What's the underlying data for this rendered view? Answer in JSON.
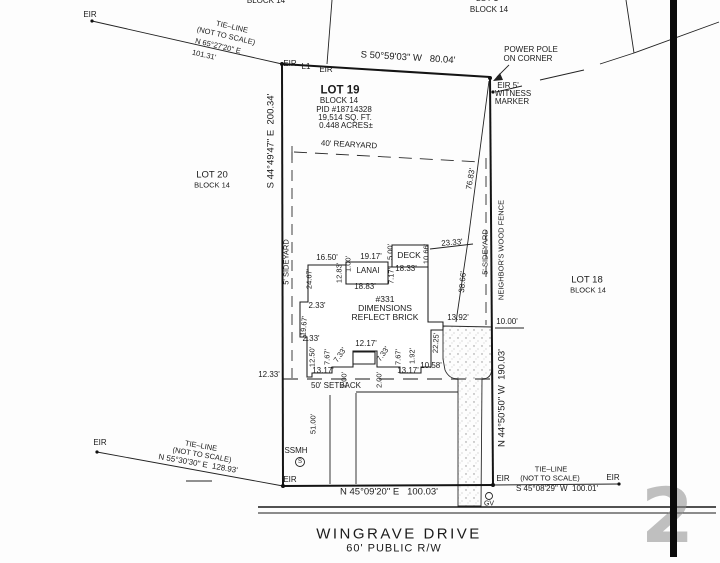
{
  "parcel": {
    "lot": "LOT 19",
    "block": "BLOCK 14",
    "pid": "PID #18714328",
    "area_sqft": "19,514 SQ. FT.",
    "area_acres": "0.448 ACRES±",
    "house_number": "#331",
    "note": "DIMENSIONS REFLECT BRICK"
  },
  "street": {
    "name": "WINGRAVE DRIVE",
    "right_of_way": "60' PUBLIC R/W"
  },
  "boundaries": {
    "north": "S 50°59'03\" W 80.04'",
    "west": "S 44°49'47\" E 200.34'",
    "east": "N 44°50'50\" W 190.03'",
    "south": "N 45°09'20\" E 100.03'"
  },
  "adjacent_lots": [
    "LOT 20 BLOCK 14",
    "LOT 18 BLOCK 14",
    "BLOCK 14 (north)",
    "LOT 1 BLOCK 14 (northeast)"
  ],
  "watermark": "2",
  "colors": {
    "line": "#1b1b1b",
    "setback_dash": "#8a8a8a",
    "stipple": "#8f8f8f",
    "bar": "#0b0b0b"
  },
  "labels": [
    {
      "id": "block-label-top-left",
      "t": "BLOCK 14",
      "x": 266,
      "y": 1,
      "s": 8
    },
    {
      "id": "lot-label-top-right",
      "t": "LOT 1",
      "x": 487,
      "y": -1,
      "s": 8
    },
    {
      "id": "block-label-top-right",
      "t": "BLOCK 14",
      "x": 489,
      "y": 10,
      "s": 8
    },
    {
      "id": "eir-marker-label",
      "t": "EIR",
      "x": 90,
      "y": 15,
      "s": 8
    },
    {
      "id": "tie-line-nw-title",
      "t": "TIE–LINE",
      "x": 232,
      "y": 27,
      "s": 7.5,
      "rot": 13
    },
    {
      "id": "tie-line-nw-note",
      "t": "(NOT TO SCALE)",
      "x": 226,
      "y": 36,
      "s": 7.5,
      "rot": 13
    },
    {
      "id": "tie-line-nw-bearing",
      "t": "N 65°27'20\" E",
      "x": 218,
      "y": 46,
      "s": 7.5,
      "rot": 13
    },
    {
      "id": "tie-line-nw-distance",
      "t": "101.31'",
      "x": 204,
      "y": 55,
      "s": 7.5,
      "rot": 13
    },
    {
      "id": "bearing-north",
      "t": "S 50°59'03\" W   80.04'",
      "x": 408,
      "y": 58,
      "s": 9.5,
      "rot": 3.5
    },
    {
      "id": "eir-marker-label",
      "t": "EIR",
      "x": 290,
      "y": 64,
      "s": 8
    },
    {
      "id": "line-l1-label",
      "t": "L1",
      "x": 306,
      "y": 67,
      "s": 8
    },
    {
      "id": "eir-marker-label",
      "t": "EIR",
      "x": 326,
      "y": 70,
      "s": 8
    },
    {
      "id": "power-pole-note-1",
      "t": "POWER POLE",
      "x": 531,
      "y": 50,
      "s": 8
    },
    {
      "id": "power-pole-note-2",
      "t": "ON CORNER",
      "x": 528,
      "y": 59,
      "s": 8
    },
    {
      "id": "witness-marker-note-1",
      "t": "EIR 5'",
      "x": 508,
      "y": 86,
      "s": 8
    },
    {
      "id": "witness-marker-note-2",
      "t": "WITNESS",
      "x": 513,
      "y": 94,
      "s": 8
    },
    {
      "id": "witness-marker-note-3",
      "t": "MARKER",
      "x": 512,
      "y": 102,
      "s": 8
    },
    {
      "id": "lot19-name",
      "t": "LOT 19",
      "x": 340,
      "y": 91,
      "s": 11.5,
      "w": 700
    },
    {
      "id": "lot19-block",
      "t": "BLOCK 14",
      "x": 339,
      "y": 101,
      "s": 8
    },
    {
      "id": "lot19-pid",
      "t": "PID #18714328",
      "x": 344,
      "y": 110,
      "s": 8
    },
    {
      "id": "lot19-area-sqft",
      "t": "19,514 SQ. FT.",
      "x": 345,
      "y": 118,
      "s": 8
    },
    {
      "id": "lot19-area-acres",
      "t": "0.448 ACRES±",
      "x": 346,
      "y": 126,
      "s": 8
    },
    {
      "id": "rearyard-label",
      "t": "40' REARYARD",
      "x": 349,
      "y": 145,
      "s": 8,
      "rot": 3
    },
    {
      "id": "lot20-name",
      "t": "LOT 20",
      "x": 212,
      "y": 175,
      "s": 9.5
    },
    {
      "id": "lot20-block",
      "t": "BLOCK 14",
      "x": 212,
      "y": 185,
      "s": 7.5
    },
    {
      "id": "lot18-name",
      "t": "LOT 18",
      "x": 587,
      "y": 280,
      "s": 9.5
    },
    {
      "id": "lot18-block",
      "t": "BLOCK 14",
      "x": 588,
      "y": 290,
      "s": 7.5
    },
    {
      "id": "bearing-west",
      "t": "S 44°49'47\" E  200.34'",
      "x": 271,
      "y": 141,
      "s": 9.5,
      "rot": -90
    },
    {
      "id": "sideyard-west-label",
      "t": "5' SIDEYARD",
      "x": 286,
      "y": 262,
      "s": 7.5,
      "rot": -90
    },
    {
      "id": "dim",
      "t": "76.83'",
      "x": 471,
      "y": 179,
      "s": 8,
      "rot": -80
    },
    {
      "id": "fence-label",
      "t": "NEIGHBOR'S WOOD FENCE",
      "x": 501,
      "y": 250,
      "s": 7.5,
      "rot": -90
    },
    {
      "id": "sideyard-east-label",
      "t": "5' SIDEYARD",
      "x": 485,
      "y": 252,
      "s": 7.5,
      "rot": -90
    },
    {
      "id": "dim",
      "t": "38.66'",
      "x": 463,
      "y": 282,
      "s": 8,
      "rot": -85
    },
    {
      "id": "dim",
      "t": "23.33'",
      "x": 452,
      "y": 243,
      "s": 8,
      "rot": -5
    },
    {
      "id": "dim",
      "t": "16.50'",
      "x": 327,
      "y": 258,
      "s": 8
    },
    {
      "id": "dim",
      "t": "1.00'",
      "x": 348,
      "y": 264,
      "s": 7.5,
      "rot": -90
    },
    {
      "id": "dim",
      "t": "12.83'",
      "x": 339,
      "y": 273,
      "s": 7.5,
      "rot": -90
    },
    {
      "id": "dim",
      "t": "19.17'",
      "x": 371,
      "y": 257,
      "s": 8
    },
    {
      "id": "lanai-label",
      "t": "LANAI",
      "x": 368,
      "y": 271,
      "s": 8
    },
    {
      "id": "dim",
      "t": "5.00'",
      "x": 390,
      "y": 252,
      "s": 7.5,
      "rot": -90
    },
    {
      "id": "deck-label",
      "t": "DECK",
      "x": 409,
      "y": 255,
      "s": 8.5
    },
    {
      "id": "dim",
      "t": "10.66'",
      "x": 426,
      "y": 254,
      "s": 7.5,
      "rot": -90
    },
    {
      "id": "dim",
      "t": "18.33'",
      "x": 406,
      "y": 269,
      "s": 8
    },
    {
      "id": "dim",
      "t": "7.17'",
      "x": 391,
      "y": 276,
      "s": 7.5,
      "rot": -90
    },
    {
      "id": "dim",
      "t": "18.83'",
      "x": 365,
      "y": 287,
      "s": 8
    },
    {
      "id": "dim",
      "t": "24.67'",
      "x": 309,
      "y": 279,
      "s": 7.5,
      "rot": -90
    },
    {
      "id": "dim",
      "t": "2.33'",
      "x": 317,
      "y": 306,
      "s": 8
    },
    {
      "id": "dim",
      "t": "19.67'",
      "x": 304,
      "y": 326,
      "s": 7.5,
      "rot": -85
    },
    {
      "id": "house-number",
      "t": "#331",
      "x": 385,
      "y": 299,
      "s": 8.5
    },
    {
      "id": "house-note-1",
      "t": "DIMENSIONS",
      "x": 385,
      "y": 308,
      "s": 8.5
    },
    {
      "id": "house-note-2",
      "t": "REFLECT BRICK",
      "x": 385,
      "y": 317,
      "s": 8.5
    },
    {
      "id": "dim",
      "t": "13.92'",
      "x": 458,
      "y": 318,
      "s": 8
    },
    {
      "id": "dim",
      "t": "10.00'",
      "x": 507,
      "y": 322,
      "s": 8
    },
    {
      "id": "dim",
      "t": "2.33'",
      "x": 311,
      "y": 339,
      "s": 8
    },
    {
      "id": "dim",
      "t": "12.50'",
      "x": 312,
      "y": 357,
      "s": 7.5,
      "rot": -90
    },
    {
      "id": "dim",
      "t": "7.67'",
      "x": 327,
      "y": 357,
      "s": 7.5,
      "rot": -90
    },
    {
      "id": "dim",
      "t": "7.33'",
      "x": 340,
      "y": 355,
      "s": 7.5,
      "rot": -55
    },
    {
      "id": "dim",
      "t": "12.17'",
      "x": 366,
      "y": 344,
      "s": 8
    },
    {
      "id": "dim",
      "t": "7.33'",
      "x": 383,
      "y": 354,
      "s": 7.5,
      "rot": -55
    },
    {
      "id": "dim",
      "t": "7.67'",
      "x": 398,
      "y": 357,
      "s": 7.5,
      "rot": -90
    },
    {
      "id": "dim",
      "t": "1.92'",
      "x": 412,
      "y": 356,
      "s": 7.5,
      "rot": -90
    },
    {
      "id": "dim",
      "t": "10.58'",
      "x": 431,
      "y": 366,
      "s": 8
    },
    {
      "id": "dim",
      "t": "22.25'",
      "x": 436,
      "y": 343,
      "s": 7.5,
      "rot": -87
    },
    {
      "id": "dim",
      "t": "13.17'",
      "x": 323,
      "y": 371,
      "s": 8
    },
    {
      "id": "dim",
      "t": "2.00'",
      "x": 344,
      "y": 380,
      "s": 7.5,
      "rot": -90
    },
    {
      "id": "dim",
      "t": "2.00'",
      "x": 379,
      "y": 380,
      "s": 7.5,
      "rot": -90
    },
    {
      "id": "dim",
      "t": "13.17'",
      "x": 408,
      "y": 371,
      "s": 8
    },
    {
      "id": "dim",
      "t": "12.33'",
      "x": 269,
      "y": 375,
      "s": 8
    },
    {
      "id": "setback-label",
      "t": "50' SETBACK",
      "x": 336,
      "y": 386,
      "s": 8
    },
    {
      "id": "dim",
      "t": "51.00'",
      "x": 313,
      "y": 424,
      "s": 7.5,
      "rot": -90
    },
    {
      "id": "bearing-east",
      "t": "N 44°50'50\" W  190.03'",
      "x": 502,
      "y": 398,
      "s": 9.5,
      "rot": -90
    },
    {
      "id": "ssmh-label",
      "t": "SSMH",
      "x": 296,
      "y": 451,
      "s": 8
    },
    {
      "id": "ssmh-symbol-letter",
      "t": "S",
      "x": 300,
      "y": 462,
      "s": 6
    },
    {
      "id": "eir-marker-label",
      "t": "EIR",
      "x": 100,
      "y": 443,
      "s": 8
    },
    {
      "id": "tie-line-sw-title",
      "t": "TIE–LINE",
      "x": 201,
      "y": 446,
      "s": 7.5,
      "rot": 10
    },
    {
      "id": "tie-line-sw-note",
      "t": "(NOT TO SCALE)",
      "x": 202,
      "y": 455,
      "s": 7.5,
      "rot": 10
    },
    {
      "id": "tie-line-sw-bearing",
      "t": "N 55°30'30\" E  128.93'",
      "x": 198,
      "y": 464,
      "s": 8,
      "rot": 10
    },
    {
      "id": "eir-marker-label",
      "t": "EIR",
      "x": 290,
      "y": 480,
      "s": 8
    },
    {
      "id": "bearing-south",
      "t": "N 45°09'20\" E   100.03'",
      "x": 389,
      "y": 492,
      "s": 9.5
    },
    {
      "id": "eir-marker-label",
      "t": "EIR",
      "x": 503,
      "y": 479,
      "s": 8
    },
    {
      "id": "tie-line-se-title",
      "t": "TIE–LINE",
      "x": 551,
      "y": 469,
      "s": 7.5
    },
    {
      "id": "tie-line-se-note",
      "t": "(NOT TO SCALE)",
      "x": 550,
      "y": 478,
      "s": 7.5
    },
    {
      "id": "tie-line-se-bearing",
      "t": "S 45°08'29\" W  100.01'",
      "x": 557,
      "y": 489,
      "s": 8
    },
    {
      "id": "eir-marker-label",
      "t": "EIR",
      "x": 613,
      "y": 478,
      "s": 8
    },
    {
      "id": "gv-label",
      "t": "GV",
      "x": 489,
      "y": 504,
      "s": 7
    },
    {
      "id": "street-name",
      "t": "WINGRAVE DRIVE",
      "x": 399,
      "y": 534,
      "s": 15,
      "ls": 2.5
    },
    {
      "id": "street-rw",
      "t": "60' PUBLIC R/W",
      "x": 394,
      "y": 549,
      "s": 11,
      "ls": 1
    }
  ]
}
